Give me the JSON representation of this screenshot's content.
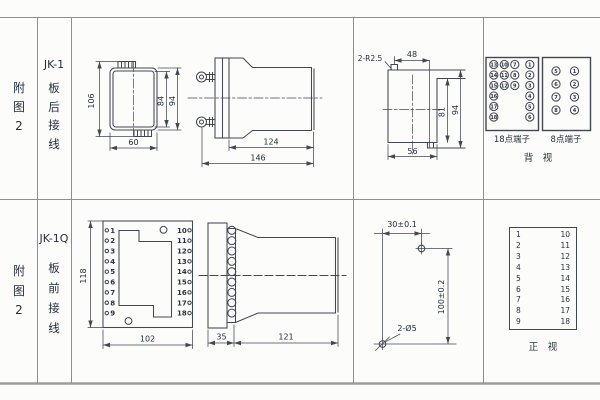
{
  "page": {
    "bg": "#fcfcfb",
    "ink": "#2b3140",
    "line_color": "#434751",
    "grid_color": "#8f8f8f"
  },
  "row1": {
    "fig_label": [
      "附",
      "图",
      "2"
    ],
    "model": "JK-1",
    "wiring": [
      "板",
      "后",
      "接",
      "线"
    ],
    "front_view": {
      "d106": "106",
      "d60": "60",
      "d84": "84",
      "d94": "94"
    },
    "side_view": {
      "d124": "124",
      "d146": "146"
    },
    "cutout": {
      "radius": "2-R2.5",
      "d48": "48",
      "d56": "56",
      "d81": "81",
      "d94": "94"
    },
    "terminals18": {
      "label": "18点端子",
      "cells": [
        {
          "v": "13",
          "c": 0,
          "r": 0
        },
        {
          "v": "14",
          "c": 0,
          "r": 1
        },
        {
          "v": "15",
          "c": 0,
          "r": 2
        },
        {
          "v": "16",
          "c": 0,
          "r": 3
        },
        {
          "v": "17",
          "c": 0,
          "r": 4
        },
        {
          "v": "18",
          "c": 0,
          "r": 5
        },
        {
          "v": "10",
          "c": 1,
          "r": 0
        },
        {
          "v": "11",
          "c": 1,
          "r": 1
        },
        {
          "v": "12",
          "c": 1,
          "r": 2
        },
        {
          "v": "7",
          "c": 2,
          "r": 0
        },
        {
          "v": "8",
          "c": 2,
          "r": 1
        },
        {
          "v": "9",
          "c": 2,
          "r": 2
        },
        {
          "v": "1",
          "c": 3,
          "r": 0
        },
        {
          "v": "2",
          "c": 3,
          "r": 1
        },
        {
          "v": "3",
          "c": 3,
          "r": 2
        },
        {
          "v": "4",
          "c": 3,
          "r": 3
        },
        {
          "v": "5",
          "c": 3,
          "r": 4
        },
        {
          "v": "6",
          "c": 3,
          "r": 5
        }
      ]
    },
    "terminals8": {
      "label": "8点端子",
      "cells": [
        {
          "v": "5",
          "c": 0,
          "r": 0
        },
        {
          "v": "6",
          "c": 0,
          "r": 1
        },
        {
          "v": "7",
          "c": 0,
          "r": 2
        },
        {
          "v": "8",
          "c": 0,
          "r": 3
        },
        {
          "v": "1",
          "c": 1,
          "r": 0
        },
        {
          "v": "2",
          "c": 1,
          "r": 1
        },
        {
          "v": "3",
          "c": 1,
          "r": 2
        },
        {
          "v": "4",
          "c": 1,
          "r": 3
        }
      ]
    },
    "view_label": "背　视"
  },
  "row2": {
    "fig_label": [
      "附",
      "图",
      "2"
    ],
    "model": "JK-1Q",
    "wiring": [
      "板",
      "前",
      "接",
      "线"
    ],
    "front_view": {
      "left": [
        "1",
        "2",
        "3",
        "4",
        "5",
        "6",
        "7",
        "8",
        "9"
      ],
      "right": [
        "10",
        "11",
        "12",
        "13",
        "14",
        "15",
        "16",
        "17",
        "18"
      ],
      "d118": "118",
      "d102": "102"
    },
    "side_view": {
      "d35": "35",
      "d121": "121"
    },
    "drill": {
      "d30": "30±0.1",
      "d100": "100±0.2",
      "holes": "2-Ø5"
    },
    "table": {
      "left": [
        "1",
        "2",
        "3",
        "4",
        "5",
        "6",
        "7",
        "8",
        "9"
      ],
      "right": [
        "10",
        "11",
        "12",
        "13",
        "14",
        "15",
        "16",
        "17",
        "18"
      ],
      "view_label": "正　视"
    }
  }
}
